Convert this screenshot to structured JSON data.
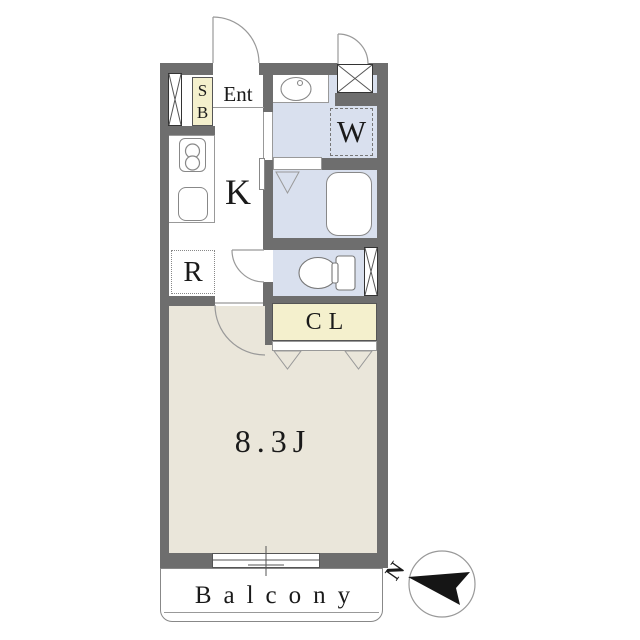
{
  "plan": {
    "entrance": {
      "label": "Ent"
    },
    "shoe_box": {
      "line1": "S",
      "line2": "B"
    },
    "kitchen": {
      "label": "K"
    },
    "refrigerator_space": {
      "label": "R"
    },
    "washer_space": {
      "label": "W"
    },
    "closet": {
      "label": "CL"
    },
    "main_room": {
      "area_label": "8.3J"
    },
    "balcony": {
      "label": "Balcony"
    },
    "compass": {
      "north_label": "N"
    },
    "colors": {
      "wall": "#6e6e6e",
      "wet_room_floor": "#d9e0ee",
      "main_room_floor": "#eae6da",
      "storage_fill": "#f4f0cd",
      "outline": "#999999",
      "text": "#1a1a1a"
    }
  }
}
